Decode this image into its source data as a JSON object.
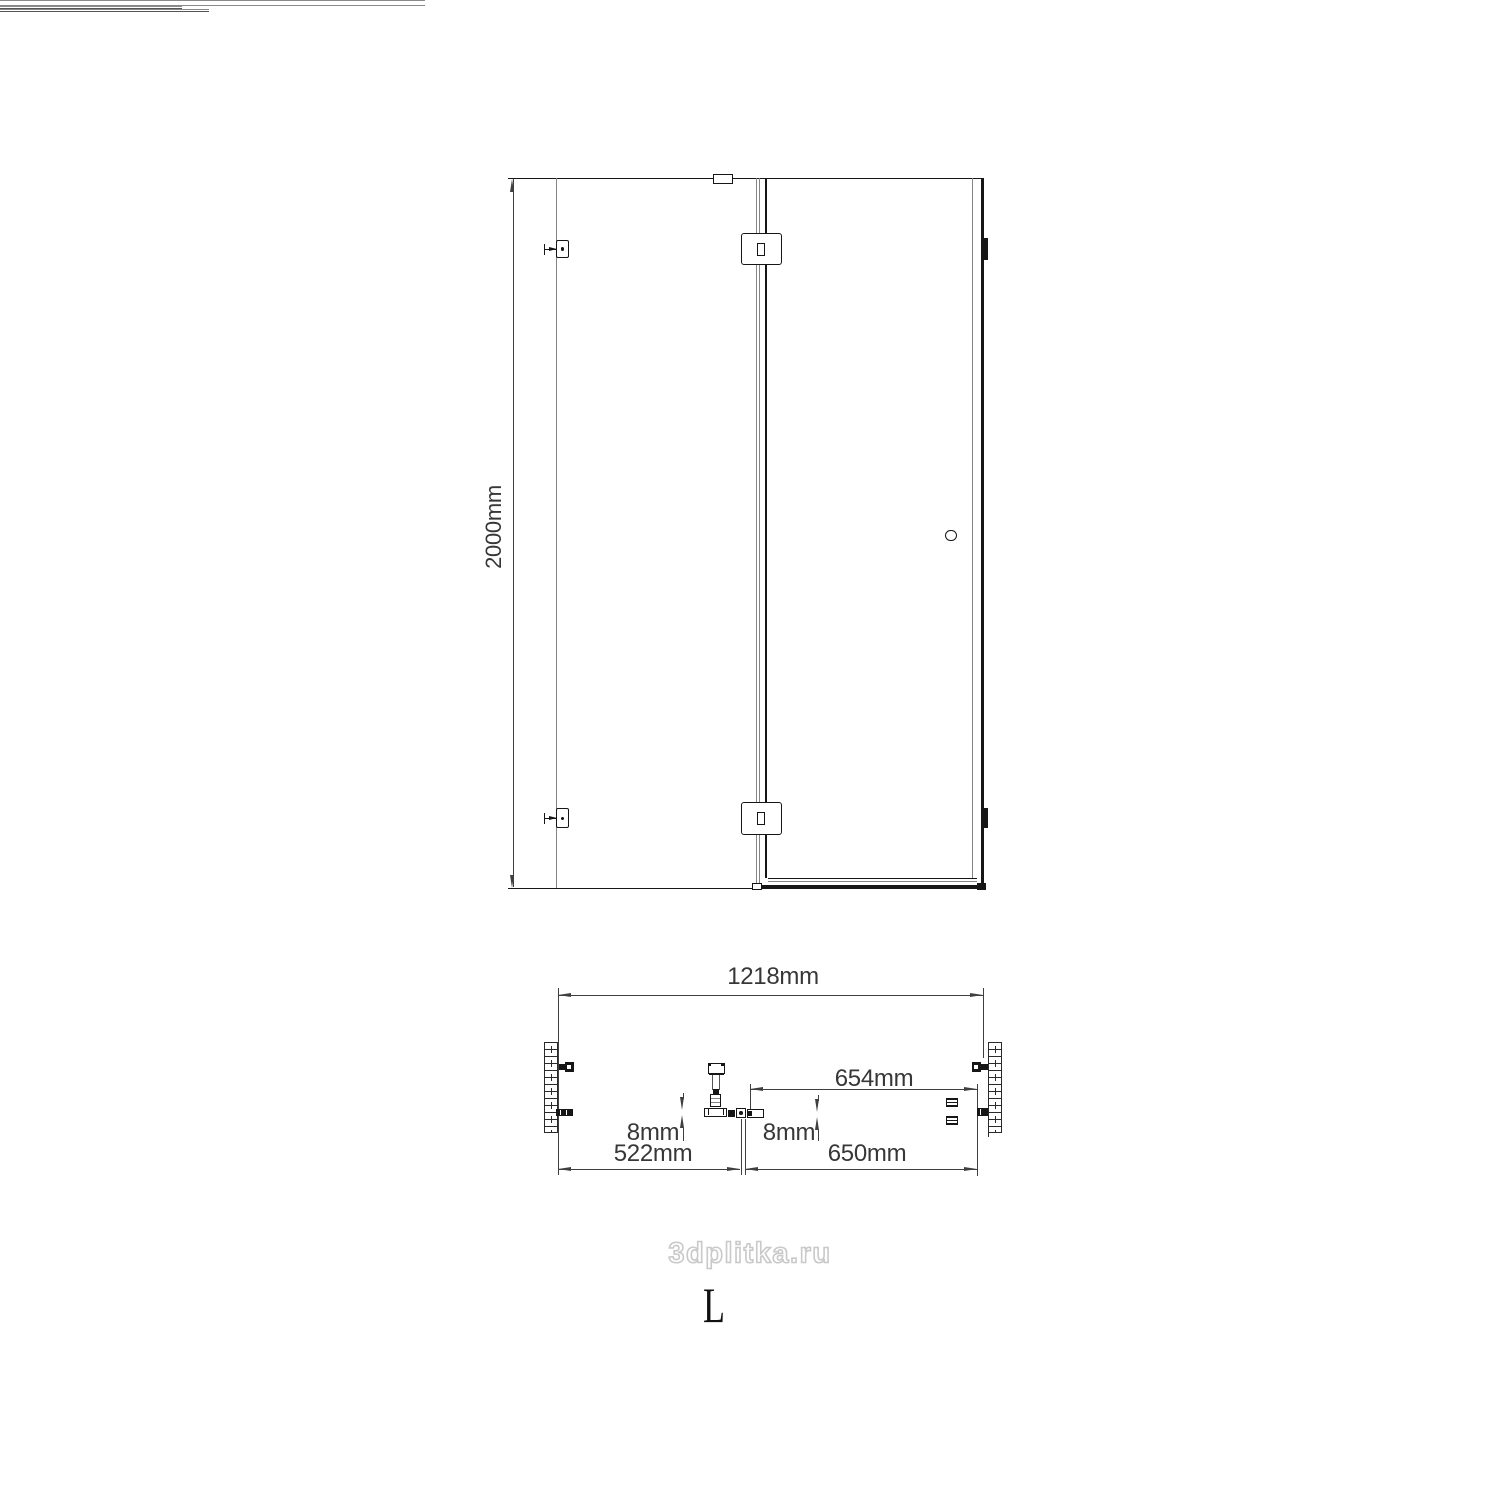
{
  "drawing": {
    "type": "shower-enclosure-technical-drawing",
    "colors": {
      "background": "#ffffff",
      "outline": "#161616",
      "glass_line": "#8a8a8a",
      "dimension_line": "#3f3f3f",
      "dimension_text": "#373737",
      "watermark_outline": "#c9c9c9"
    },
    "front_view": {
      "height_label": "2000mm"
    },
    "plan_view": {
      "overall_width_label": "1218mm",
      "door_width_label": "654mm",
      "fixed_glass_thickness_label": "8mm",
      "door_glass_thickness_label": "8mm",
      "fixed_panel_width_label": "522mm",
      "door_opening_width_label": "650mm"
    },
    "watermark": {
      "text": "3dplitka.ru"
    },
    "orientation": {
      "letter": "L"
    }
  }
}
